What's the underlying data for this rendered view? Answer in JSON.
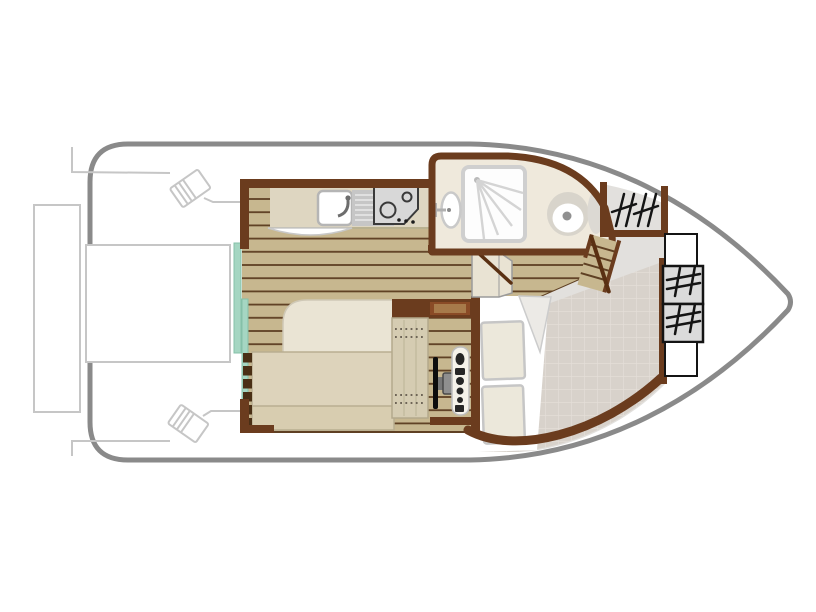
{
  "page": {
    "title": "Houseboat deck plan",
    "canvas": {
      "width": 816,
      "height": 612
    }
  },
  "palette": {
    "hull_stroke": "#8a8a8a",
    "outline_light": "#c6c6c6",
    "wall_brown": "#6b3c1e",
    "wall_brown_dark": "#5a3012",
    "cabinet_brown": "#8a4b26",
    "cabinet_brown_light": "#a77a4a",
    "wood_base": "#c7b78f",
    "wood_line": "#5f4023",
    "counter": "#ded6c1",
    "counter_edge": "#b9b190",
    "steel": "#c6c6c6",
    "cooktop_face": "#d8d8d8",
    "cooktop_line": "#3a3a3a",
    "bath_floor": "#efe9dc",
    "fixture_rim": "#c9c9c9",
    "toilet_rim": "#d8d4cb",
    "toilet_dot": "#909090",
    "vanity_gray": "#dcd9d3",
    "teal_door": "#a5d6c2",
    "teal_door_edge": "#85c0a8",
    "bed_head": "#eae4d4",
    "bed_main": "#ddd3bb",
    "bed_foot": "#d8cdb0",
    "seat_tan": "#d5ccb2",
    "stitch": "#6d6456",
    "deck_smooth": "#e2e0dd",
    "deck_tile": "#d8d2cb",
    "tile_line": "#e4ded8",
    "cushion": "#ece8db",
    "cushion_edge": "#c6c6c6",
    "hatch_gray": "#dbdbdb",
    "glyph_black": "#141414",
    "console_face": "#f5f2ea",
    "control_dark": "#262626",
    "wheel_black": "#0d0d0d",
    "white": "#ffffff"
  },
  "plan": {
    "vessel_name": "motor-cruiser-hull",
    "areas": [
      {
        "id": "stern-deck",
        "name": "aft-deck-with-boarding-steps"
      },
      {
        "id": "galley",
        "name": "galley-sink-drainer-two-burner-hob"
      },
      {
        "id": "salon-bed",
        "name": "double-bed"
      },
      {
        "id": "helm-station",
        "name": "wheel-console-helm-seat"
      },
      {
        "id": "bathroom",
        "name": "shower-washbasin-toilet"
      },
      {
        "id": "companionway",
        "name": "steps-to-bow-deck"
      },
      {
        "id": "bow-cockpit",
        "name": "bow-cockpit-cushions-table"
      },
      {
        "id": "bow-lockers",
        "name": "bow-hatch-and-seat-lockers"
      }
    ]
  }
}
